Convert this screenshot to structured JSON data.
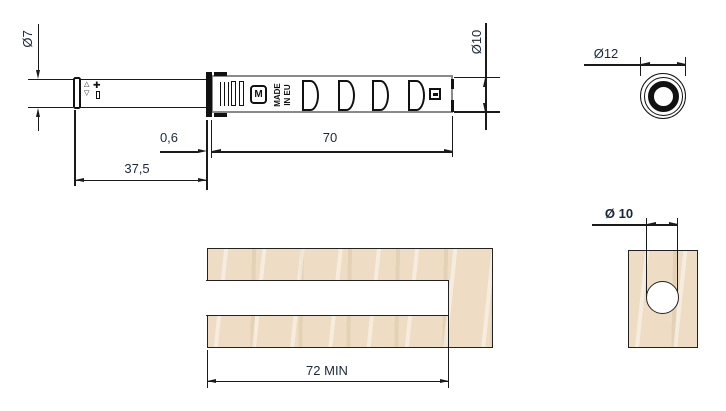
{
  "drawing": {
    "side_view": {
      "logo": "M",
      "made_in": "MADE\nIN EU",
      "symbols": {
        "triangle_up": "△",
        "triangle_down": "▽",
        "plus": "✚"
      }
    },
    "dimensions": {
      "plunger_diameter": "Ø7",
      "flange_thickness": "0,6",
      "plunger_length": "37,5",
      "body_length": "70",
      "body_diameter": "Ø10",
      "face_diameter": "Ø12",
      "hole_diameter": "Ø 10",
      "hole_depth": "72 MIN"
    },
    "colors": {
      "wood": "#eeddc4",
      "line": "#1a1a1a",
      "dim_text": "#1b2838",
      "body_outline": "#8a8a8a"
    }
  }
}
